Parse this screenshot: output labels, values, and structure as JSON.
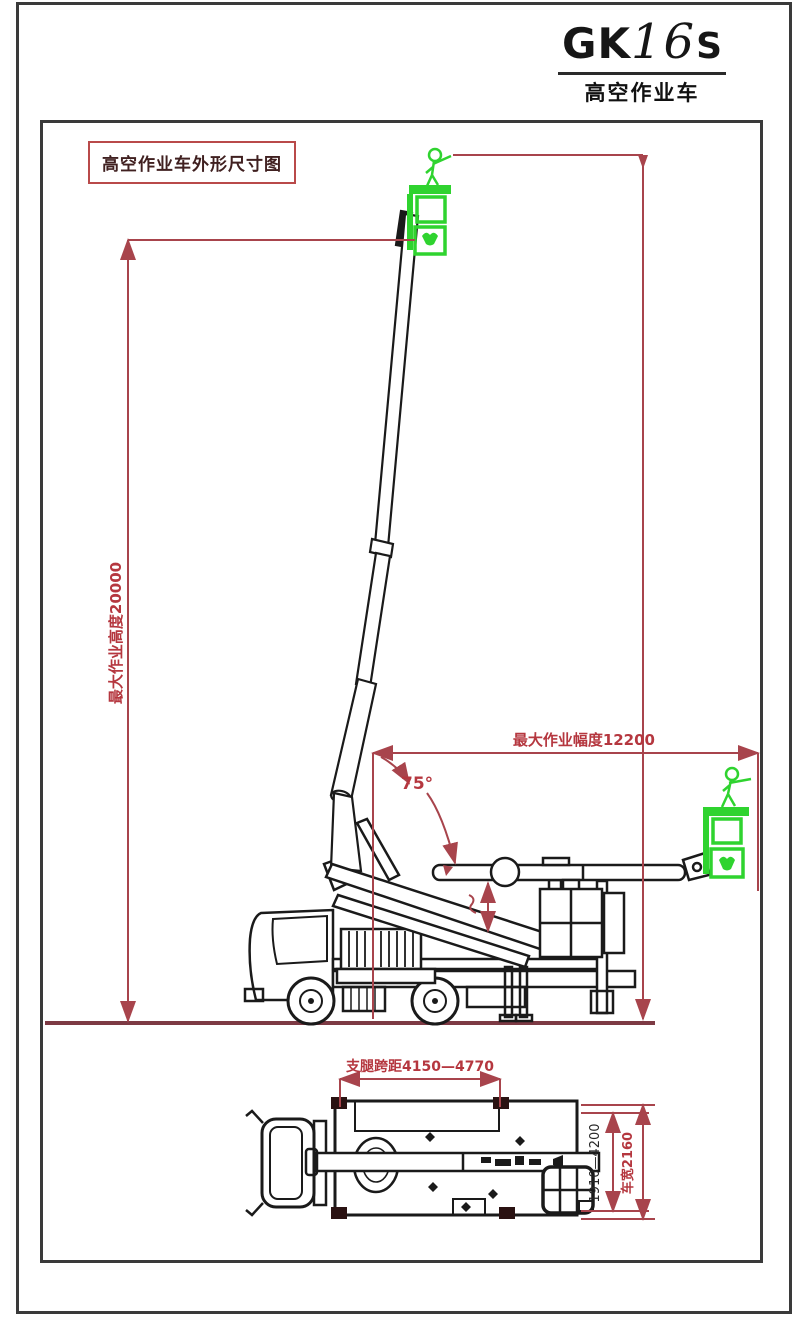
{
  "title_block": {
    "model_prefix": "GK",
    "model_digits": "16",
    "model_suffix": "S",
    "model_full": "GK16S",
    "subtitle": "高空作业车"
  },
  "drawing": {
    "caption": "高空作业车外形尺寸图",
    "dims": {
      "max_working_height": "最大作业高度20000",
      "max_working_radius": "最大作业幅度12200",
      "boom_angle": "75°",
      "outrigger_span": "支腿跨距4150—4770",
      "outrigger_width_range": "1910—4200",
      "vehicle_width": "车宽2160"
    },
    "colors": {
      "dimension_red": "#a8444c",
      "label_red": "#b5373f",
      "ground_red": "#7d3a44",
      "basket_green": "#2fd32f",
      "line_black": "#1a1a1a"
    }
  }
}
